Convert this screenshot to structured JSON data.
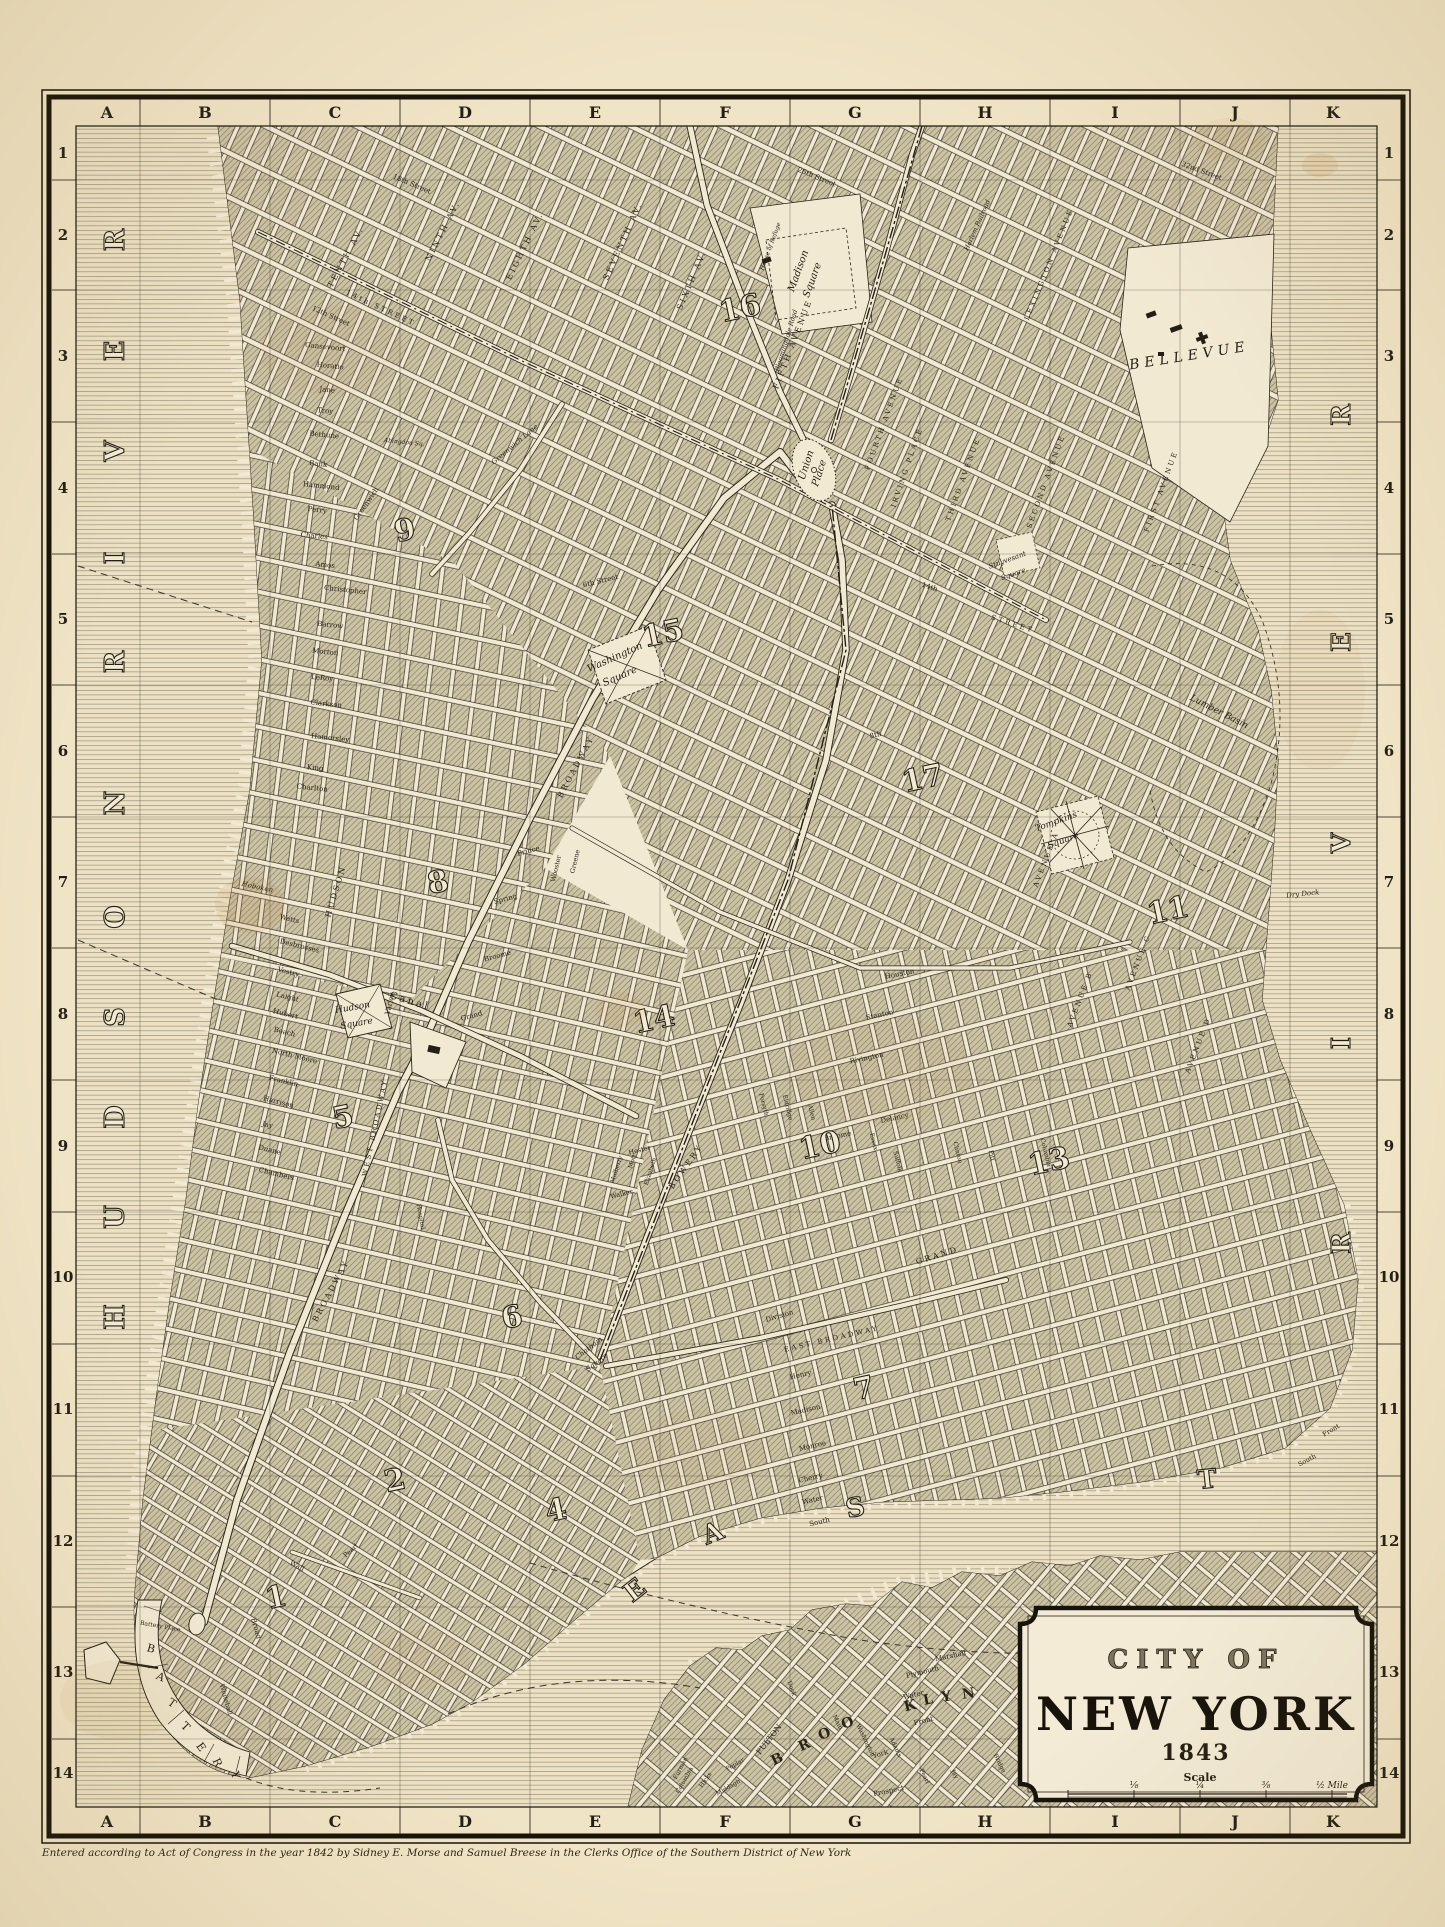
{
  "map_title": "City of New York 1843 engraved street map",
  "title_cartouche": {
    "line1": "CITY OF",
    "line2": "NEW YORK",
    "year": "1843",
    "scale_label": "Scale",
    "scale_ticks": [
      "⅛",
      "¼",
      "⅜",
      "½ Mile"
    ]
  },
  "copyright": "Entered according to Act of Congress in the year 1842 by Sidney E. Morse and Samuel Breese in the Clerks Office of the Southern District of New York",
  "grid": {
    "columns": [
      "A",
      "B",
      "C",
      "D",
      "E",
      "F",
      "G",
      "H",
      "I",
      "J",
      "K"
    ],
    "rows": [
      "1",
      "2",
      "3",
      "4",
      "5",
      "6",
      "7",
      "8",
      "9",
      "10",
      "11",
      "12",
      "13",
      "14"
    ]
  },
  "water_letters": [
    [
      "R",
      124,
      240,
      -90,
      27
    ],
    [
      "E",
      124,
      351,
      -90,
      27
    ],
    [
      "V",
      124,
      451,
      -90,
      27
    ],
    [
      "I",
      124,
      558,
      -90,
      27
    ],
    [
      "R",
      124,
      662,
      -90,
      27
    ],
    [
      "N",
      124,
      803,
      -90,
      27
    ],
    [
      "O",
      124,
      917,
      -90,
      27
    ],
    [
      "S",
      124,
      1017,
      -90,
      27
    ],
    [
      "D",
      124,
      1117,
      -90,
      27
    ],
    [
      "U",
      124,
      1217,
      -90,
      27
    ],
    [
      "H",
      124,
      1317,
      -90,
      27
    ],
    [
      "R",
      1350,
      415,
      -90,
      26
    ],
    [
      "E",
      1350,
      642,
      -90,
      26
    ],
    [
      "V",
      1350,
      843,
      -90,
      26
    ],
    [
      "I",
      1350,
      1043,
      -90,
      26
    ],
    [
      "R",
      1350,
      1243,
      -90,
      26
    ],
    [
      "E",
      640,
      1597,
      -38,
      26
    ],
    [
      "A",
      716,
      1541,
      -22,
      26
    ],
    [
      "S",
      857,
      1516,
      -12,
      26
    ],
    [
      "T",
      1208,
      1488,
      -6,
      26
    ],
    [
      "B",
      779,
      1763,
      -26,
      14,
      "d"
    ],
    [
      "R",
      806,
      1749,
      -24,
      14,
      "d"
    ],
    [
      "O",
      826,
      1738,
      -22,
      14,
      "d"
    ],
    [
      "O",
      849,
      1727,
      -20,
      14,
      "d"
    ],
    [
      "K",
      911,
      1710,
      -14,
      14,
      "d"
    ],
    [
      "L",
      929,
      1704,
      -12,
      14,
      "d"
    ],
    [
      "Y",
      947,
      1701,
      -10,
      14,
      "d"
    ],
    [
      "N",
      969,
      1698,
      -8,
      14,
      "d"
    ]
  ],
  "district_numbers": [
    [
      "1",
      278,
      1607
    ],
    [
      "2",
      397,
      1490
    ],
    [
      "4",
      558,
      1520
    ],
    [
      "5",
      345,
      1127
    ],
    [
      "6",
      514,
      1327
    ],
    [
      "7",
      866,
      1398
    ],
    [
      "8",
      440,
      892
    ],
    [
      "9",
      407,
      540
    ],
    [
      "10",
      822,
      1155
    ],
    [
      "11",
      1170,
      920
    ],
    [
      "13",
      1051,
      1171
    ],
    [
      "14",
      656,
      1029
    ],
    [
      "15",
      665,
      643
    ],
    [
      "16",
      742,
      318
    ],
    [
      "17",
      925,
      788
    ]
  ],
  "labels": [
    [
      "TENTH AV.",
      348,
      258,
      -62,
      8,
      "sp"
    ],
    [
      "NINTH AV.",
      445,
      232,
      -63,
      8,
      "sp"
    ],
    [
      "EIGHTH AV.",
      527,
      247,
      -64,
      8,
      "sp"
    ],
    [
      "SEVENTH AV.",
      625,
      242,
      -66,
      8,
      "sp"
    ],
    [
      "SIXTH AV.",
      694,
      281,
      -67,
      8,
      "sp"
    ],
    [
      "FIFTH AVENUE",
      795,
      345,
      -69,
      8,
      "sp"
    ],
    [
      "FOURTH AVENUE",
      886,
      424,
      -70,
      7,
      "sp"
    ],
    [
      "THIRD AVENUE",
      965,
      480,
      -70,
      7,
      "sp"
    ],
    [
      "IRVING PLACE",
      909,
      468,
      -71,
      7,
      "sp"
    ],
    [
      "LEXINGTON AVENUE",
      1051,
      265,
      -68,
      7,
      "sp"
    ],
    [
      "SECOND AVENUE",
      1048,
      482,
      -70,
      7,
      "sp"
    ],
    [
      "FIRST AVENUE",
      1163,
      492,
      -70,
      7,
      "sp"
    ],
    [
      "AVENUE A",
      1048,
      860,
      -69,
      7,
      "sp"
    ],
    [
      "AVENUE B",
      1082,
      1000,
      -69,
      7,
      "sp"
    ],
    [
      "AVENUE C",
      1140,
      963,
      -69,
      7,
      "sp"
    ],
    [
      "AVENUE D",
      1200,
      1046,
      -69,
      7,
      "sp"
    ],
    [
      "BOWERY",
      688,
      1168,
      -55,
      8,
      "sp"
    ],
    [
      "BROADWAY",
      578,
      768,
      -62,
      8,
      "sp"
    ],
    [
      "BROADWAY",
      333,
      1292,
      -62,
      8,
      "sp"
    ],
    [
      "WEST BROADWAY",
      377,
      1128,
      -78,
      7,
      "sp"
    ],
    [
      "Greenwich Lane",
      516,
      446,
      -40,
      7,
      "i"
    ],
    [
      "Bloomingdale Road",
      788,
      341,
      -73,
      6.5,
      "i"
    ],
    [
      "Harlem Railroad",
      979,
      226,
      -66,
      6.5,
      "i"
    ],
    [
      "HUDSON",
      338,
      892,
      -73,
      8,
      "sp"
    ],
    [
      "Varick",
      392,
      1004,
      -77,
      7
    ],
    [
      "Canal",
      409,
      1004,
      17,
      10,
      "sp"
    ],
    [
      "Greenwich",
      368,
      505,
      -55,
      7
    ],
    [
      "Gansevoort",
      325,
      349,
      6,
      7
    ],
    [
      "Horatio",
      330,
      368,
      6,
      7
    ],
    [
      "Jane",
      327,
      392,
      6,
      7
    ],
    [
      "Troy",
      325,
      413,
      6,
      7
    ],
    [
      "Bethune",
      324,
      437,
      6,
      7
    ],
    [
      "Bank",
      318,
      466,
      6,
      7
    ],
    [
      "Hammond",
      321,
      488,
      6,
      7
    ],
    [
      "Perry",
      317,
      512,
      6,
      7
    ],
    [
      "Charles",
      314,
      538,
      6,
      7
    ],
    [
      "Amos",
      325,
      567,
      6,
      7
    ],
    [
      "Christopher",
      345,
      592,
      6,
      7
    ],
    [
      "Barrow",
      330,
      627,
      6,
      7
    ],
    [
      "Morton",
      325,
      654,
      6,
      7
    ],
    [
      "LeRoy",
      322,
      680,
      6,
      7
    ],
    [
      "Clarkson",
      326,
      706,
      6,
      7
    ],
    [
      "Hamersley",
      330,
      740,
      6,
      7
    ],
    [
      "King",
      315,
      770,
      6,
      7
    ],
    [
      "Charlton",
      312,
      790,
      6,
      7
    ],
    [
      "12th Street",
      330,
      318,
      24,
      7
    ],
    [
      "14th STREET",
      380,
      310,
      25,
      7,
      "sp"
    ],
    [
      "Abingdon Sq.",
      404,
      444,
      6,
      6,
      "i"
    ],
    [
      "Watts",
      289,
      921,
      14,
      7
    ],
    [
      "Desbrosses",
      299,
      948,
      14,
      7
    ],
    [
      "Vestry",
      288,
      974,
      14,
      7
    ],
    [
      "Laight",
      287,
      999,
      14,
      7
    ],
    [
      "Hubert",
      285,
      1016,
      14,
      7
    ],
    [
      "Beach",
      284,
      1034,
      14,
      7
    ],
    [
      "North Moore",
      294,
      1058,
      14,
      7
    ],
    [
      "Franklin",
      283,
      1083,
      14,
      7
    ],
    [
      "Harrison",
      278,
      1104,
      14,
      7
    ],
    [
      "Jay",
      267,
      1127,
      14,
      7
    ],
    [
      "Duane",
      269,
      1152,
      14,
      7
    ],
    [
      "Chambers",
      276,
      1176,
      14,
      7
    ],
    [
      "Hoboken",
      257,
      889,
      12,
      7,
      "i"
    ],
    [
      "Hospital",
      419,
      1217,
      80,
      6
    ],
    [
      "Spring",
      506,
      901,
      -15,
      7
    ],
    [
      "Prince",
      529,
      853,
      -15,
      7
    ],
    [
      "Broome",
      498,
      958,
      -15,
      7
    ],
    [
      "Grand",
      472,
      1018,
      -15,
      7
    ],
    [
      "Wooster",
      558,
      869,
      -77,
      6.5
    ],
    [
      "Greene",
      577,
      862,
      -77,
      6.5
    ],
    [
      "Houston",
      900,
      976,
      -11,
      7
    ],
    [
      "Stanton",
      880,
      1017,
      -12,
      7
    ],
    [
      "Rivington",
      867,
      1060,
      -12,
      7
    ],
    [
      "Delancy",
      895,
      1120,
      -12,
      7
    ],
    [
      "Broome",
      838,
      1138,
      -12,
      7
    ],
    [
      "GRAND",
      938,
      1258,
      -17,
      8,
      "sp"
    ],
    [
      "Walker",
      622,
      1196,
      -14,
      6.5
    ],
    [
      "Hester",
      640,
      1152,
      -14,
      6.5
    ],
    [
      "Mott",
      634,
      1162,
      -72,
      6
    ],
    [
      "Mulberry",
      618,
      1170,
      -72,
      6
    ],
    [
      "Elizabeth",
      652,
      1172,
      -72,
      6
    ],
    [
      "Forsyth",
      762,
      1105,
      76,
      6
    ],
    [
      "Eldridge",
      786,
      1108,
      76,
      6
    ],
    [
      "Allen",
      810,
      1113,
      76,
      6
    ],
    [
      "Essex",
      872,
      1142,
      76,
      6
    ],
    [
      "Clinton",
      956,
      1153,
      76,
      6
    ],
    [
      "Suffolk",
      896,
      1162,
      76,
      6
    ],
    [
      "Pitt",
      990,
      1156,
      76,
      6
    ],
    [
      "Columbia",
      1044,
      1153,
      76,
      6
    ],
    [
      "Division",
      780,
      1318,
      -16,
      7
    ],
    [
      "EAST BROADWAY",
      832,
      1341,
      -13,
      7,
      "sp"
    ],
    [
      "Henry",
      801,
      1377,
      -13,
      7
    ],
    [
      "Madison",
      806,
      1412,
      -13,
      7
    ],
    [
      "Monroe",
      813,
      1448,
      -13,
      7
    ],
    [
      "Cherry",
      811,
      1480,
      -13,
      7
    ],
    [
      "Water",
      813,
      1502,
      -13,
      7
    ],
    [
      "South",
      820,
      1524,
      -13,
      7
    ],
    [
      "South",
      1308,
      1462,
      -28,
      6.5
    ],
    [
      "Front",
      1332,
      1432,
      -30,
      6.5
    ],
    [
      "18th Street",
      411,
      186,
      23,
      7
    ],
    [
      "25th Street",
      816,
      179,
      22,
      7
    ],
    [
      "32nd Street",
      1201,
      173,
      20,
      7
    ],
    [
      "6th Street",
      601,
      583,
      -14,
      7
    ],
    [
      "8th",
      876,
      737,
      -13,
      7
    ],
    [
      "14th",
      929,
      589,
      18,
      7
    ],
    [
      "STREET",
      1012,
      626,
      18,
      7,
      "sp"
    ],
    [
      "Washington",
      616,
      660,
      -24,
      10,
      "i"
    ],
    [
      "Square",
      621,
      679,
      -24,
      10,
      "i"
    ],
    [
      "Union",
      809,
      466,
      -72,
      10,
      "i"
    ],
    [
      "Place",
      822,
      474,
      -72,
      10,
      "i"
    ],
    [
      "Madison",
      801,
      272,
      -70,
      10,
      "i"
    ],
    [
      "Square",
      815,
      281,
      -70,
      10,
      "i"
    ],
    [
      "House of Refuge",
      772,
      247,
      -70,
      6,
      "i"
    ],
    [
      "Tompkins",
      1057,
      824,
      -20,
      9,
      "i"
    ],
    [
      "Square",
      1064,
      843,
      -20,
      9,
      "i"
    ],
    [
      "Hudson",
      353,
      1010,
      -10,
      9,
      "i"
    ],
    [
      "Square",
      357,
      1026,
      -10,
      9,
      "i"
    ],
    [
      "Stuyvesant",
      1008,
      562,
      -20,
      7,
      "i"
    ],
    [
      "Square",
      1014,
      576,
      -20,
      7,
      "i"
    ],
    [
      "Chatham",
      590,
      1350,
      -38,
      7,
      "i"
    ],
    [
      "Square",
      598,
      1364,
      -38,
      7,
      "i"
    ],
    [
      "BELLEVUE",
      1190,
      360,
      -9,
      14,
      "i sp2"
    ],
    [
      "Lumber Basin",
      1218,
      714,
      27,
      9,
      "i"
    ],
    [
      "Dry Dock",
      1303,
      896,
      -6,
      7,
      "i"
    ],
    [
      "Wall",
      296,
      1568,
      28,
      7
    ],
    [
      "Broad",
      254,
      1629,
      74,
      7
    ],
    [
      "Whitehall",
      224,
      1700,
      74,
      6.5
    ],
    [
      "Battery Place",
      160,
      1628,
      10,
      6
    ],
    [
      "Pearl",
      352,
      1552,
      -42,
      6.5
    ],
    [
      "B",
      150,
      1652,
      15,
      11
    ],
    [
      "A",
      159,
      1680,
      25,
      11
    ],
    [
      "T",
      170,
      1706,
      35,
      11
    ],
    [
      "T",
      183,
      1729,
      45,
      11
    ],
    [
      "E",
      198,
      1749,
      55,
      11
    ],
    [
      "R",
      214,
      1764,
      65,
      11
    ],
    [
      "Y",
      232,
      1776,
      75,
      11
    ],
    [
      "FULTON",
      771,
      1741,
      -52,
      8
    ],
    [
      "Front",
      924,
      1723,
      -14,
      7
    ],
    [
      "Water",
      914,
      1697,
      -14,
      7
    ],
    [
      "Plymouth",
      923,
      1674,
      -14,
      7
    ],
    [
      "Marshall",
      951,
      1658,
      -12,
      7
    ],
    [
      "York",
      881,
      1756,
      -16,
      7
    ],
    [
      "Prospect",
      889,
      1793,
      -12,
      7
    ],
    [
      "Washington",
      864,
      1741,
      64,
      6
    ],
    [
      "Adams",
      894,
      1748,
      64,
      6
    ],
    [
      "Pearl",
      923,
      1777,
      64,
      6
    ],
    [
      "Jay",
      953,
      1775,
      64,
      6
    ],
    [
      "Bridge",
      998,
      1764,
      64,
      6
    ],
    [
      "Main",
      836,
      1723,
      64,
      6
    ],
    [
      "Hicks",
      707,
      1781,
      -55,
      6
    ],
    [
      "Columbia",
      686,
      1781,
      -60,
      6
    ],
    [
      "Poplar",
      736,
      1766,
      -30,
      6
    ],
    [
      "Middagh",
      729,
      1789,
      -30,
      6
    ],
    [
      "Furman",
      682,
      1769,
      -62,
      6
    ],
    [
      "Dock",
      790,
      1689,
      70,
      6
    ]
  ]
}
